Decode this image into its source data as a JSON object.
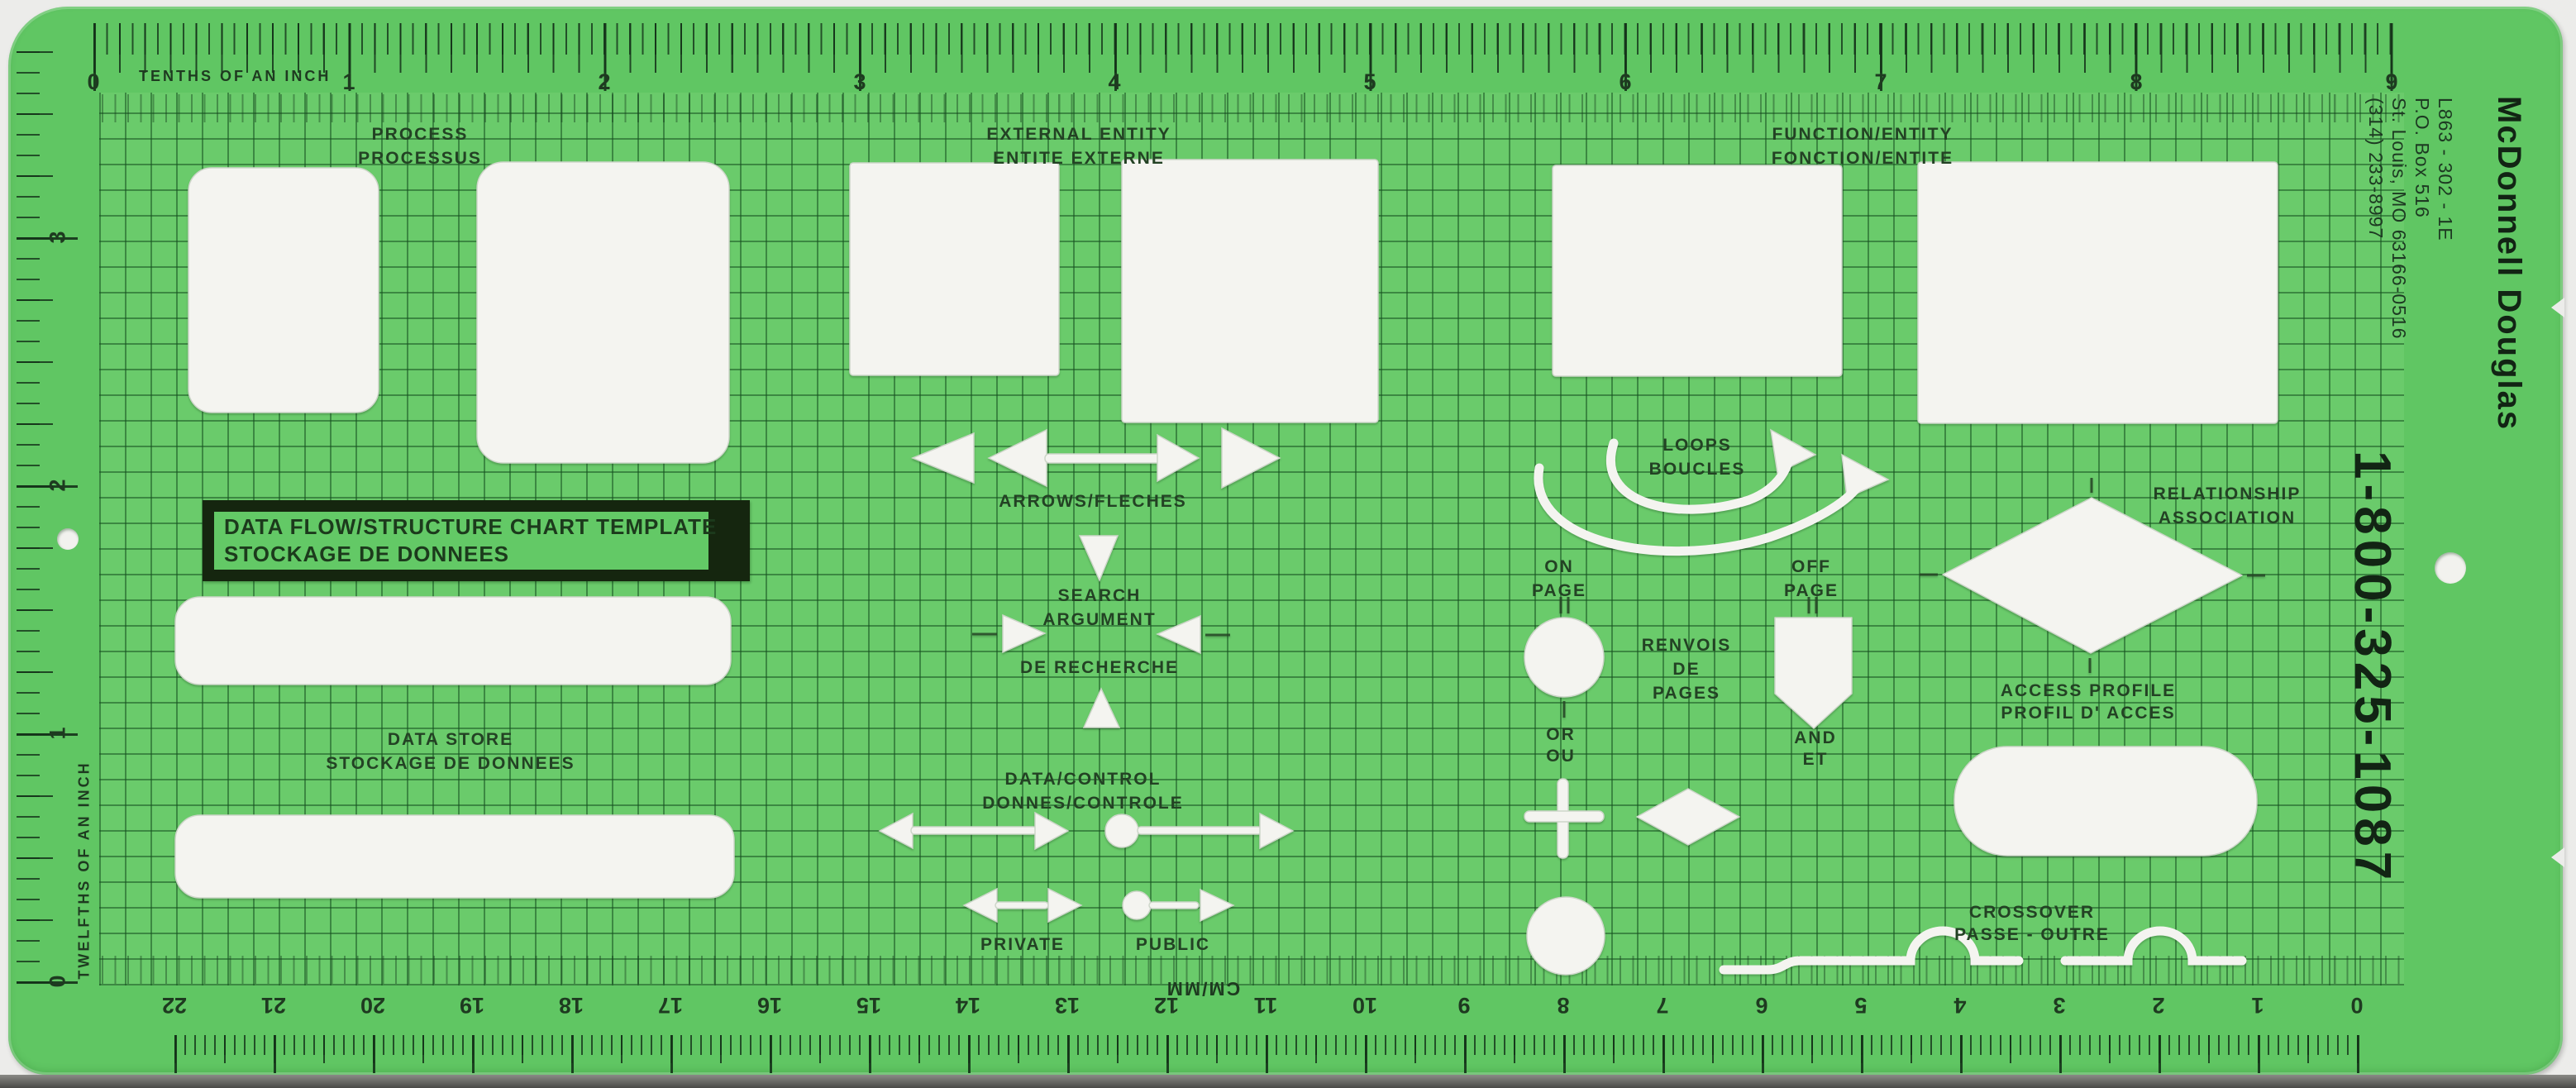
{
  "brand": {
    "name": "McDonnell Douglas",
    "part_number": "L863 - 302 - 1E",
    "po_box": "P.O. Box 516",
    "city_line": "St. Louis, MO 63166-0516",
    "phone": "(314) 233-8997",
    "tollfree": "1-800-325-1087"
  },
  "plate": {
    "line1": "DATA FLOW/STRUCTURE CHART TEMPLATE",
    "line2": "STOCKAGE DE DONNEES"
  },
  "rulers": {
    "top": {
      "caption": "TENTHS OF AN INCH",
      "numbers": [
        "0",
        "1",
        "2",
        "3",
        "4",
        "5",
        "6",
        "7",
        "8",
        "9"
      ]
    },
    "left": {
      "caption": "TWELFTHS OF AN INCH",
      "numbers": [
        "3",
        "2",
        "1",
        "0"
      ]
    },
    "bottom": {
      "caption": "CM/MM",
      "numbers": [
        "22",
        "21",
        "20",
        "19",
        "18",
        "17",
        "16",
        "15",
        "14",
        "13",
        "12",
        "11",
        "10",
        "9",
        "8",
        "7",
        "6",
        "5",
        "4",
        "3",
        "2",
        "1",
        "0"
      ]
    }
  },
  "labels": {
    "process": {
      "en": "PROCESS",
      "fr": "PROCESSUS"
    },
    "external_entity": {
      "en": "EXTERNAL ENTITY",
      "fr": "ENTITE EXTERNE"
    },
    "function_entity": {
      "en": "FUNCTION/ENTITY",
      "fr": "FONCTION/ENTITE"
    },
    "arrows": {
      "en": "ARROWS/FLECHES"
    },
    "search_argument": {
      "l1": "SEARCH",
      "l2": "ARGUMENT",
      "l3": "DE RECHERCHE"
    },
    "loops": {
      "en": "LOOPS",
      "fr": "BOUCLES"
    },
    "on_page": {
      "l1": "ON",
      "l2": "PAGE"
    },
    "off_page": {
      "l1": "OFF",
      "l2": "PAGE"
    },
    "page_refs": {
      "l1": "RENVOIS",
      "l2": "DE",
      "l3": "PAGES"
    },
    "or": {
      "en": "OR",
      "fr": "OU"
    },
    "and": {
      "en": "AND",
      "fr": "ET"
    },
    "relationship": {
      "en": "RELATIONSHIP",
      "fr": "ASSOCIATION"
    },
    "data_store": {
      "en": "DATA STORE",
      "fr": "STOCKAGE DE DONNEES"
    },
    "data_control": {
      "en": "DATA/CONTROL",
      "fr": "DONNES/CONTROLE"
    },
    "access_profile": {
      "en": "ACCESS PROFILE",
      "fr": "PROFIL D' ACCES"
    },
    "private": {
      "en": "PRIVATE"
    },
    "public": {
      "en": "PUBLIC"
    },
    "crossover": {
      "en": "CROSSOVER",
      "fr": "PASSE - OUTRE"
    }
  },
  "colors": {
    "template_green": "#60c663",
    "grid_field_green": "#6acb6b",
    "grid_line_green": "#2b6e33",
    "ink_dark_green": "#1e3620",
    "cutout_white": "#f4f4f0",
    "plate_black": "#15260f",
    "scan_background": "#ececea"
  }
}
